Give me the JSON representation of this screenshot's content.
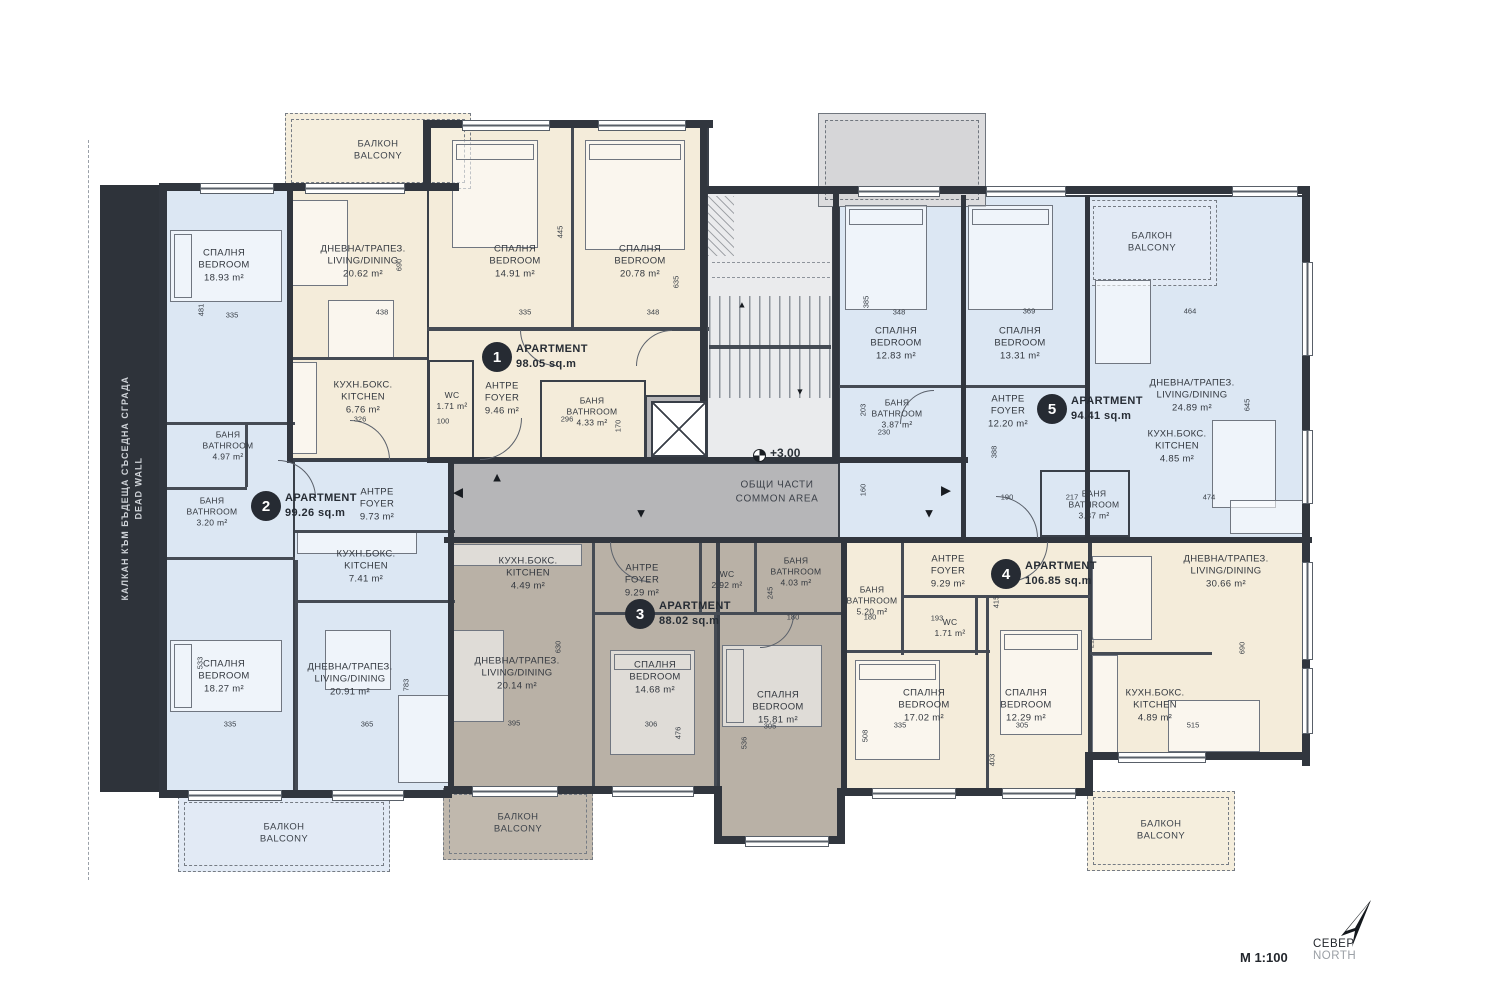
{
  "title_block": {
    "scale": "М 1:100",
    "north_bg": "СЕВЕР",
    "north_en": "NORTH"
  },
  "plan": {
    "level": "+3.00",
    "common_area_bg": "ОБЩИ ЧАСТИ",
    "common_area_en": "COMMON AREA",
    "dead_wall_bg": "КАЛКАН КЪМ БЪДЕЩА СЪСЕДНА СГРАДА",
    "dead_wall_en": "DEAD WALL",
    "balcony_bg": "БАЛКОН",
    "balcony_en": "BALCONY"
  },
  "arrows": {
    "left": "◀",
    "right": "▶",
    "up": "▲",
    "down": "▼"
  },
  "apartments": [
    {
      "number": "1",
      "label": "APARTMENT",
      "area": "98.05 sq.m",
      "rooms": [
        {
          "bg": "ДНЕВНА/ТРАПЕЗ.",
          "en": "LIVING/DINING",
          "area": "20.62 m²"
        },
        {
          "bg": "КУХН.БОКС.",
          "en": "KITCHEN",
          "area": "6.76 m²"
        },
        {
          "bg": "СПАЛНЯ",
          "en": "BEDROOM",
          "area": "14.91 m²"
        },
        {
          "bg": "СПАЛНЯ",
          "en": "BEDROOM",
          "area": "20.78 m²"
        },
        {
          "bg": "WC",
          "en": "",
          "area": "1.71 m²"
        },
        {
          "bg": "АНТРЕ",
          "en": "FOYER",
          "area": "9.46 m²"
        },
        {
          "bg": "БАНЯ",
          "en": "BATHROOM",
          "area": "4.33 m²"
        }
      ]
    },
    {
      "number": "2",
      "label": "APARTMENT",
      "area": "99.26 sq.m",
      "rooms": [
        {
          "bg": "СПАЛНЯ",
          "en": "BEDROOM",
          "area": "18.93 m²"
        },
        {
          "bg": "БАНЯ",
          "en": "BATHROOM",
          "area": "4.97 m²"
        },
        {
          "bg": "БАНЯ",
          "en": "BATHROOM",
          "area": "3.20 m²"
        },
        {
          "bg": "АНТРЕ",
          "en": "FOYER",
          "area": "9.73 m²"
        },
        {
          "bg": "КУХН.БОКС.",
          "en": "KITCHEN",
          "area": "7.41 m²"
        },
        {
          "bg": "СПАЛНЯ",
          "en": "BEDROOM",
          "area": "18.27 m²"
        },
        {
          "bg": "ДНЕВНА/ТРАПЕЗ.",
          "en": "LIVING/DINING",
          "area": "20.91 m²"
        }
      ]
    },
    {
      "number": "3",
      "label": "APARTMENT",
      "area": "88.02 sq.m",
      "rooms": [
        {
          "bg": "КУХН.БОКС.",
          "en": "KITCHEN",
          "area": "4.49 m²"
        },
        {
          "bg": "АНТРЕ",
          "en": "FOYER",
          "area": "9.29 m²"
        },
        {
          "bg": "WC",
          "en": "",
          "area": "2.92 m²"
        },
        {
          "bg": "ДНЕВНА/ТРАПЕЗ.",
          "en": "LIVING/DINING",
          "area": "20.14 m²"
        },
        {
          "bg": "СПАЛНЯ",
          "en": "BEDROOM",
          "area": "14.68 m²"
        },
        {
          "bg": "БАНЯ",
          "en": "BATHROOM",
          "area": "4.03 m²"
        },
        {
          "bg": "СПАЛНЯ",
          "en": "BEDROOM",
          "area": "15.81 m²"
        }
      ]
    },
    {
      "number": "4",
      "label": "APARTMENT",
      "area": "106.85 sq.m",
      "rooms": [
        {
          "bg": "АНТРЕ",
          "en": "FOYER",
          "area": "9.29 m²"
        },
        {
          "bg": "БАНЯ",
          "en": "BATHROOM",
          "area": "5.20 m²"
        },
        {
          "bg": "WC",
          "en": "",
          "area": "1.71 m²"
        },
        {
          "bg": "СПАЛНЯ",
          "en": "BEDROOM",
          "area": "17.02 m²"
        },
        {
          "bg": "СПАЛНЯ",
          "en": "BEDROOM",
          "area": "12.29 m²"
        },
        {
          "bg": "КУХН.БОКС.",
          "en": "KITCHEN",
          "area": "4.89 m²"
        },
        {
          "bg": "ДНЕВНА/ТРАПЕЗ.",
          "en": "LIVING/DINING",
          "area": "30.66 m²"
        }
      ]
    },
    {
      "number": "5",
      "label": "APARTMENT",
      "area": "94.41 sq.m",
      "rooms": [
        {
          "bg": "СПАЛНЯ",
          "en": "BEDROOM",
          "area": "12.83 m²"
        },
        {
          "bg": "БАНЯ",
          "en": "BATHROOM",
          "area": "3.87 m²"
        },
        {
          "bg": "СПАЛНЯ",
          "en": "BEDROOM",
          "area": "13.31 m²"
        },
        {
          "bg": "АНТРЕ",
          "en": "FOYER",
          "area": "12.20 m²"
        },
        {
          "bg": "ДНЕВНА/ТРАПЕЗ.",
          "en": "LIVING/DINING",
          "area": "24.89 m²"
        },
        {
          "bg": "КУХН.БОКС.",
          "en": "KITCHEN",
          "area": "4.85 m²"
        },
        {
          "bg": "БАНЯ",
          "en": "BATHROOM",
          "area": "3.87 m²"
        }
      ]
    }
  ],
  "dims": [
    "481",
    "335",
    "438",
    "690",
    "445",
    "635",
    "335",
    "348",
    "326",
    "100",
    "296",
    "170",
    "385",
    "348",
    "369",
    "464",
    "645",
    "474",
    "388",
    "190",
    "217",
    "203",
    "230",
    "160",
    "533",
    "335",
    "365",
    "783",
    "630",
    "395",
    "306",
    "476",
    "536",
    "305",
    "508",
    "335",
    "403",
    "305",
    "515",
    "690",
    "245",
    "180",
    "180",
    "193",
    "415",
    "217"
  ]
}
